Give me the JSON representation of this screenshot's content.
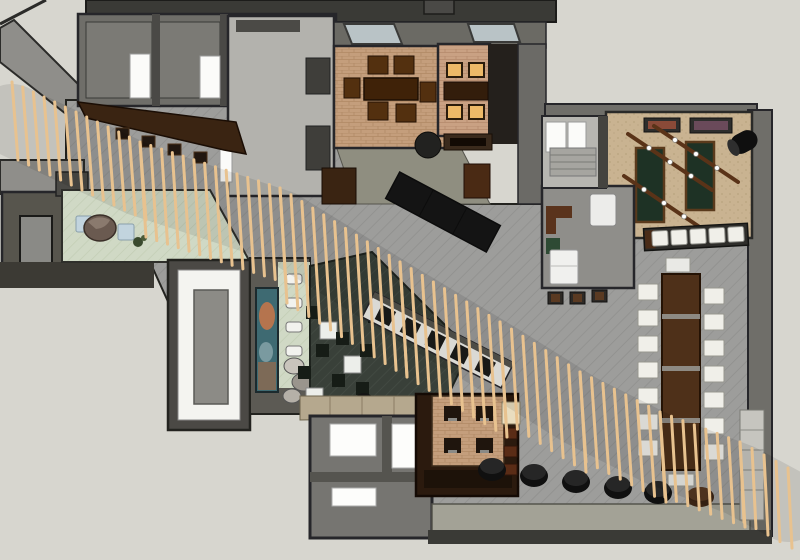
{
  "meta": {
    "description": "Top-down 3D rendering of a restaurant interior floor plan",
    "render_style": "sketchup-axonometric"
  },
  "colors": {
    "canvas": "#d7d6cf",
    "wall_dark": "#3a3a36",
    "wall_mid": "#6f6e69",
    "wall_light": "#8f8e8a",
    "outline": "#23231f",
    "hall_floor": "#9b9b99",
    "tan_floor": "#c49e7c",
    "tan_floor_2": "#c9a183",
    "games_floor": "#c9b391",
    "mint_floor": "#cfd8c4",
    "lounge_floor": "#3b423b",
    "walkway": "#a3a296",
    "slat_wood": "#e8c28f",
    "dark_wood": "#3a2412",
    "table_wood": "#4e3019",
    "chair_wood": "#53300f",
    "amber_seat": "#edb968",
    "white_furniture": "#f0efe9",
    "black_furniture": "#141414",
    "green_mat": "#1e3225",
    "blue_seat": "#c2d4de",
    "olive_band": "#8f8e80",
    "cream": "#e9ddbf",
    "art_teal": "#3e6a72",
    "art_orange": "#c2764a",
    "window_glass": "#b9c3c6"
  },
  "render": {
    "slat_width": 3,
    "slat_bands": [
      {
        "x0": 12,
        "y0": 82,
        "x1": 140,
        "y1": 142,
        "count": 13,
        "len": 78,
        "lean": 6
      },
      {
        "x0": 140,
        "y0": 142,
        "x1": 280,
        "y1": 188,
        "count": 14,
        "len": 95,
        "lean": 6
      },
      {
        "x0": 280,
        "y0": 188,
        "x1": 400,
        "y1": 262,
        "count": 12,
        "len": 115,
        "lean": 7
      },
      {
        "x0": 400,
        "y0": 262,
        "x1": 500,
        "y1": 322,
        "count": 10,
        "len": 115,
        "lean": 7
      },
      {
        "x0": 500,
        "y0": 322,
        "x1": 580,
        "y1": 372,
        "count": 8,
        "len": 100,
        "lean": 6
      },
      {
        "x0": 580,
        "y0": 372,
        "x1": 660,
        "y1": 412,
        "count": 8,
        "len": 90,
        "lean": 6
      },
      {
        "x0": 660,
        "y0": 412,
        "x1": 740,
        "y1": 442,
        "count": 8,
        "len": 85,
        "lean": 5
      },
      {
        "x0": 740,
        "y0": 442,
        "x1": 788,
        "y1": 468,
        "count": 5,
        "len": 80,
        "lean": 4
      }
    ],
    "shadow_points": "12,120 140,180 280,226 400,300 500,360 580,410 660,450 740,480 788,506",
    "communal_chairs": {
      "left_x": 638,
      "right_x": 704,
      "left_rows": [
        284,
        310,
        336,
        362,
        388,
        414,
        440
      ],
      "right_rows": [
        288,
        314,
        340,
        366,
        392,
        418,
        444
      ],
      "w": 20,
      "h": 16
    },
    "bench_cushions": {
      "x0": 652,
      "y": 229,
      "step": 19,
      "count": 5,
      "w": 16,
      "h": 15
    },
    "poufs": {
      "black": [
        [
          492,
          470
        ],
        [
          534,
          476
        ],
        [
          576,
          482
        ],
        [
          618,
          488
        ],
        [
          658,
          493
        ]
      ],
      "brown": [
        700,
        497
      ]
    },
    "rails": [
      {
        "x1": 628,
        "y1": 134,
        "x2": 712,
        "y2": 190
      },
      {
        "x1": 654,
        "y1": 126,
        "x2": 738,
        "y2": 182
      },
      {
        "x1": 624,
        "y1": 176,
        "x2": 704,
        "y2": 230
      }
    ],
    "bulb_fractions": [
      0.25,
      0.5,
      0.75
    ]
  }
}
